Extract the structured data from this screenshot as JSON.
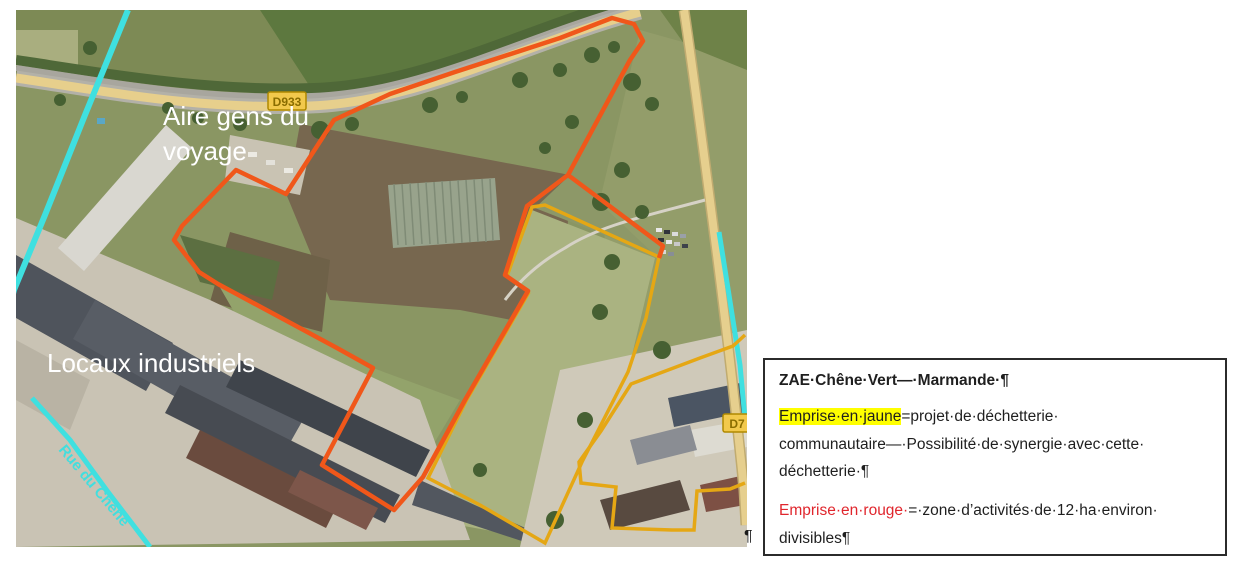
{
  "page": {
    "background": "#ffffff"
  },
  "map": {
    "description": "aerial-satellite-view",
    "road_shields": {
      "d933": "D933",
      "d7": "D7"
    },
    "labels": {
      "aire_line1": "Aire gens du",
      "aire_line2": "voyage",
      "locaux": "Locaux industriels",
      "rue": "Rue du Chêne"
    },
    "overlay_colors": {
      "zone_activites_orange": "#f0571a",
      "dechetterie_yellow": "#e5a714",
      "utility_cyan": "#3fe0e0"
    }
  },
  "paragraph_mark_after_image": "¶",
  "textbox": {
    "title": "ZAE·Chêne·Vert—·Marmande·¶",
    "para_yellow": {
      "highlight_text": "Emprise·en·jaune",
      "highlight_color": "#ffff00",
      "rest": "=projet·de·déchetterie·\ncommunautaire—·Possibilité·de·synergie·avec·cette·\ndéchetterie·¶"
    },
    "para_red": {
      "red_text": "Emprise·en·rouge·",
      "red_color": "#e0262d",
      "rest": "=·zone·d’activités·de·12·ha·environ·\ndivisibles¶"
    }
  }
}
